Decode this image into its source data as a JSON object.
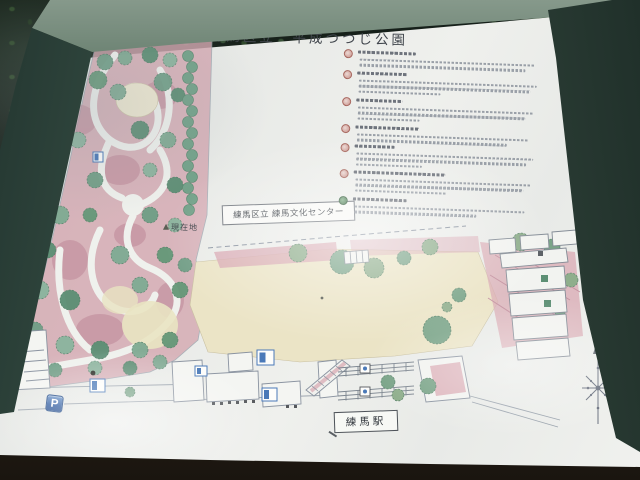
{
  "sign": {
    "title": "練馬区立　平成つつじ公園",
    "map_labels": {
      "culture_center": "練馬区立 練馬文化センター",
      "current_location": "現在地",
      "station": "練馬駅",
      "parking": "P"
    },
    "legend": {
      "item_count": 7,
      "items": [
        {
          "marker_color": "#a8685f",
          "desc_lines": 2
        },
        {
          "marker_color": "#a8685f",
          "desc_lines": 3
        },
        {
          "marker_color": "#a8685f",
          "desc_lines": 3
        },
        {
          "marker_color": "#b06a62",
          "desc_lines": 2
        },
        {
          "marker_color": "#a8685f",
          "desc_lines": 3
        },
        {
          "marker_color": "#a8685f",
          "desc_lines": 3
        },
        {
          "marker_color": "#4e7d52",
          "desc_lines": 2
        }
      ],
      "legibility": "small print not resolvable in source photo"
    },
    "colors": {
      "frame_patina": "#3f584c",
      "panel_white": "#eceeeb",
      "azalea_bed_pink": "#d5a9b2",
      "tree_green": "#6f9e86",
      "plaza_cream": "#ebe4c6",
      "facility_icon_blue": "#4a79b8"
    }
  }
}
